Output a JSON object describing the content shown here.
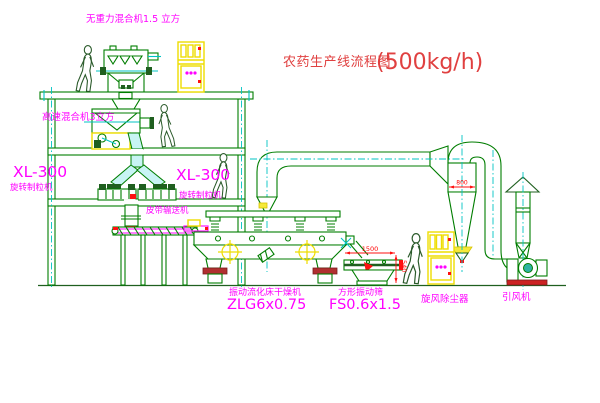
{
  "diagram": {
    "title": "农药生产线流程图",
    "title_capacity": "(500kg/h)"
  },
  "labels": {
    "gravity_mixer": "无重力混合机1.5 立方",
    "high_speed_mixer": "高速混合机3立方",
    "granulator_left_model": "XL-300",
    "granulator_left_name": "旋转制粒机",
    "granulator_right_model": "XL-300",
    "granulator_right_name": "旋转制粒机",
    "belt_conveyor": "皮带输送机",
    "fluid_bed_dryer_name": "振动流化床干燥机",
    "fluid_bed_dryer_model": "ZLG6x0.75",
    "vibrating_screen_name": "方形振动筛",
    "vibrating_screen_model": "FS0.6x1.5",
    "cyclone": "旋风除尘器",
    "induced_draft_fan": "引风机"
  },
  "dimensions": {
    "cyclone_inlet": "800",
    "screen_length": "1500",
    "screen_height": "540"
  },
  "colors": {
    "line_green": "#007d00",
    "dark_green": "#1f5f1f",
    "centerline_cyan": "#00c3c3",
    "label_magenta": "#ff00ff",
    "dimension_red": "#ff0000",
    "title_red": "#e04040",
    "equipment_yellow": "#eedd00"
  }
}
